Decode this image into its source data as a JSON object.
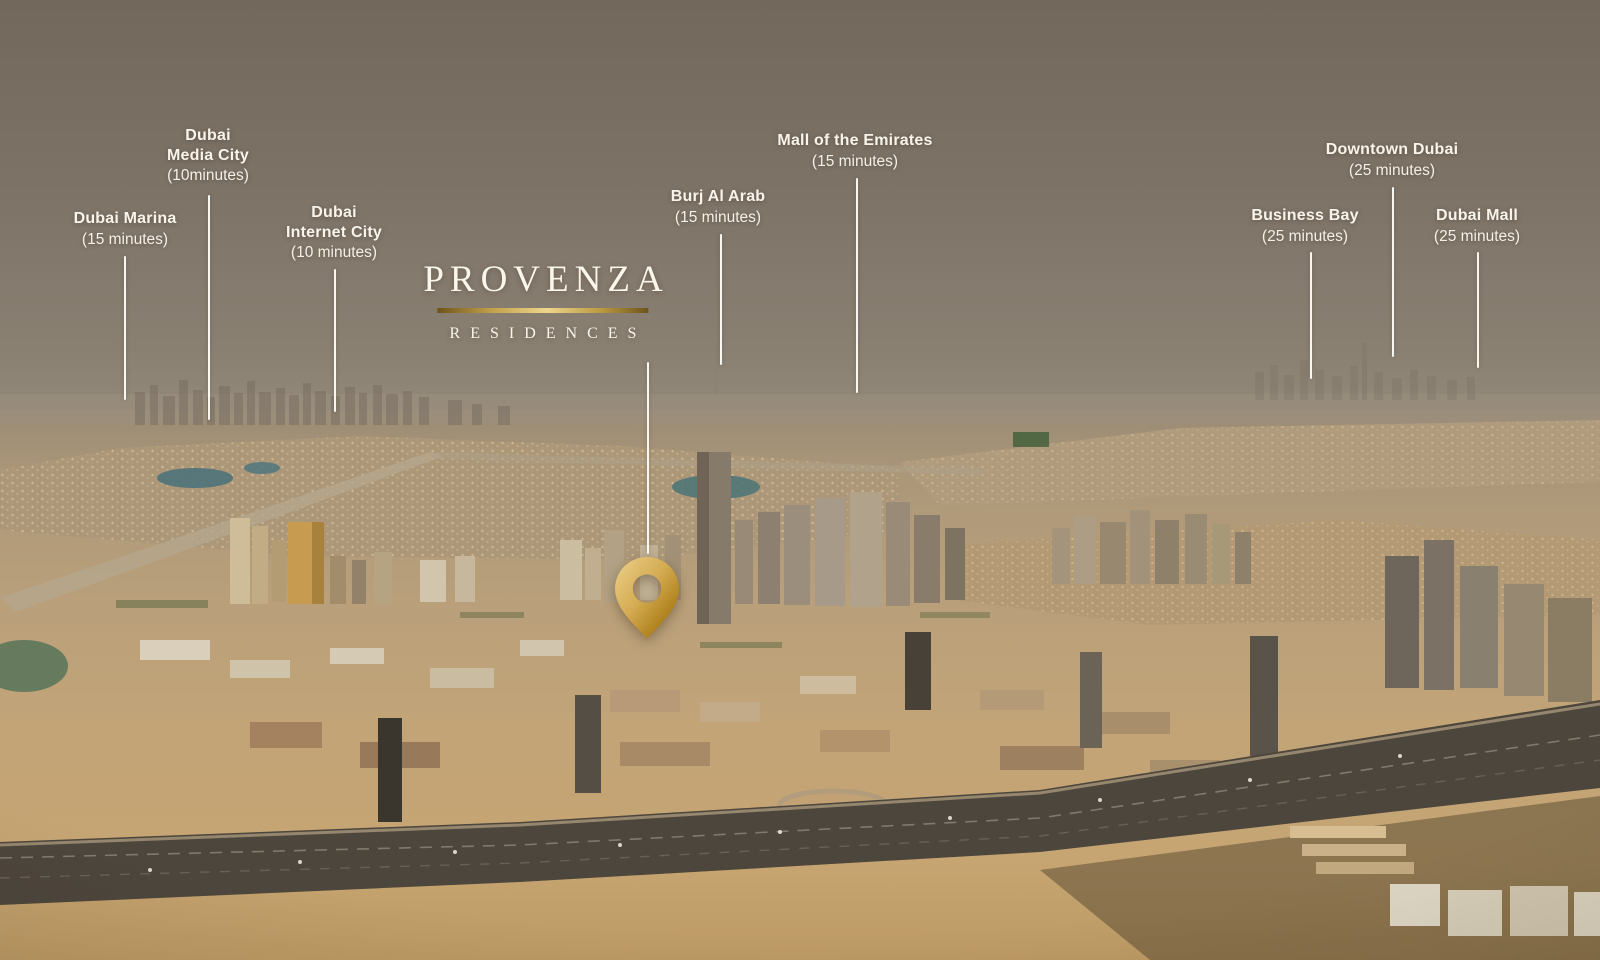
{
  "brand": {
    "name": "PROVENZA",
    "subtitle": "RESIDENCES",
    "gold_accent": "#c9a35a",
    "label_text_color": "#f8f4ec"
  },
  "pin": {
    "icon": "map-pin-icon",
    "gold_light": "#ecd18a",
    "gold_dark": "#96701c"
  },
  "locations": [
    {
      "id": "dubai-marina",
      "name": "Dubai Marina",
      "time": "(15 minutes)"
    },
    {
      "id": "dubai-media-city",
      "name": "Dubai\nMedia City",
      "time": "(10minutes)"
    },
    {
      "id": "dubai-internet-city",
      "name": "Dubai\nInternet City",
      "time": "(10 minutes)"
    },
    {
      "id": "burj-al-arab",
      "name": "Burj Al Arab",
      "time": "(15 minutes)"
    },
    {
      "id": "mall-of-the-emirates",
      "name": "Mall of the Emirates",
      "time": "(15 minutes)"
    },
    {
      "id": "business-bay",
      "name": "Business Bay",
      "time": "(25 minutes)"
    },
    {
      "id": "downtown-dubai",
      "name": "Downtown Dubai",
      "time": "(25 minutes)"
    },
    {
      "id": "dubai-mall",
      "name": "Dubai Mall",
      "time": "(25 minutes)"
    }
  ]
}
